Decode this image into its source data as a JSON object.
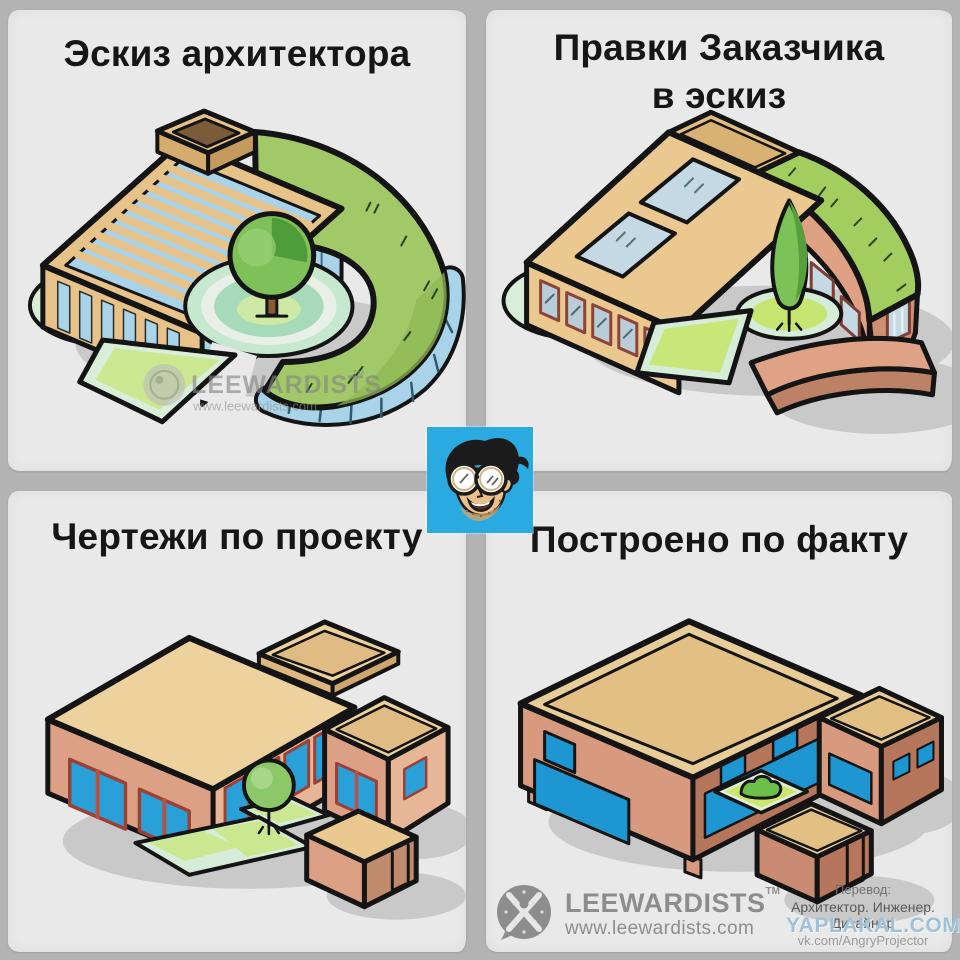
{
  "panels": {
    "sketch": {
      "title": "Эскиз архитектора"
    },
    "client_edits": {
      "title_line1": "Правки Заказчика",
      "title_line2": "в эскиз"
    },
    "blueprints": {
      "title": "Чертежи по проекту"
    },
    "as_built": {
      "title": "Построено по факту"
    }
  },
  "panel_watermark": {
    "brand": "LEEWARDISTS",
    "tm": "TM",
    "url": "www.leewardists.com"
  },
  "footer": {
    "brand": "LEEWARDISTS",
    "tm": "TM",
    "url": "www.leewardists.com",
    "translation_label": "Перевод:",
    "translation_credit": "Архитектор. Инженер. Дизайнер",
    "translation_link": "vk.com/AngryProjector"
  },
  "site_watermark": {
    "text": "YAPLAKAL.COM"
  },
  "colors": {
    "background": "#b3b3b3",
    "panel_bg": "#e9e9e9",
    "avatar_blue": "#29abe2",
    "outline": "#141414",
    "roof_tan": "#e7c289",
    "glass_blue": "#a9d3e9",
    "grass_green": "#a2c968",
    "lawn_green": "#cbe78f",
    "mint_border": "#d5ecd9",
    "wall_salmon": "#dca184",
    "wall_brown": "#b5765c",
    "window_blue": "#1d96d2",
    "logo_gray": "#8d8d8d",
    "shadow_gray": "#c8c8c8"
  }
}
